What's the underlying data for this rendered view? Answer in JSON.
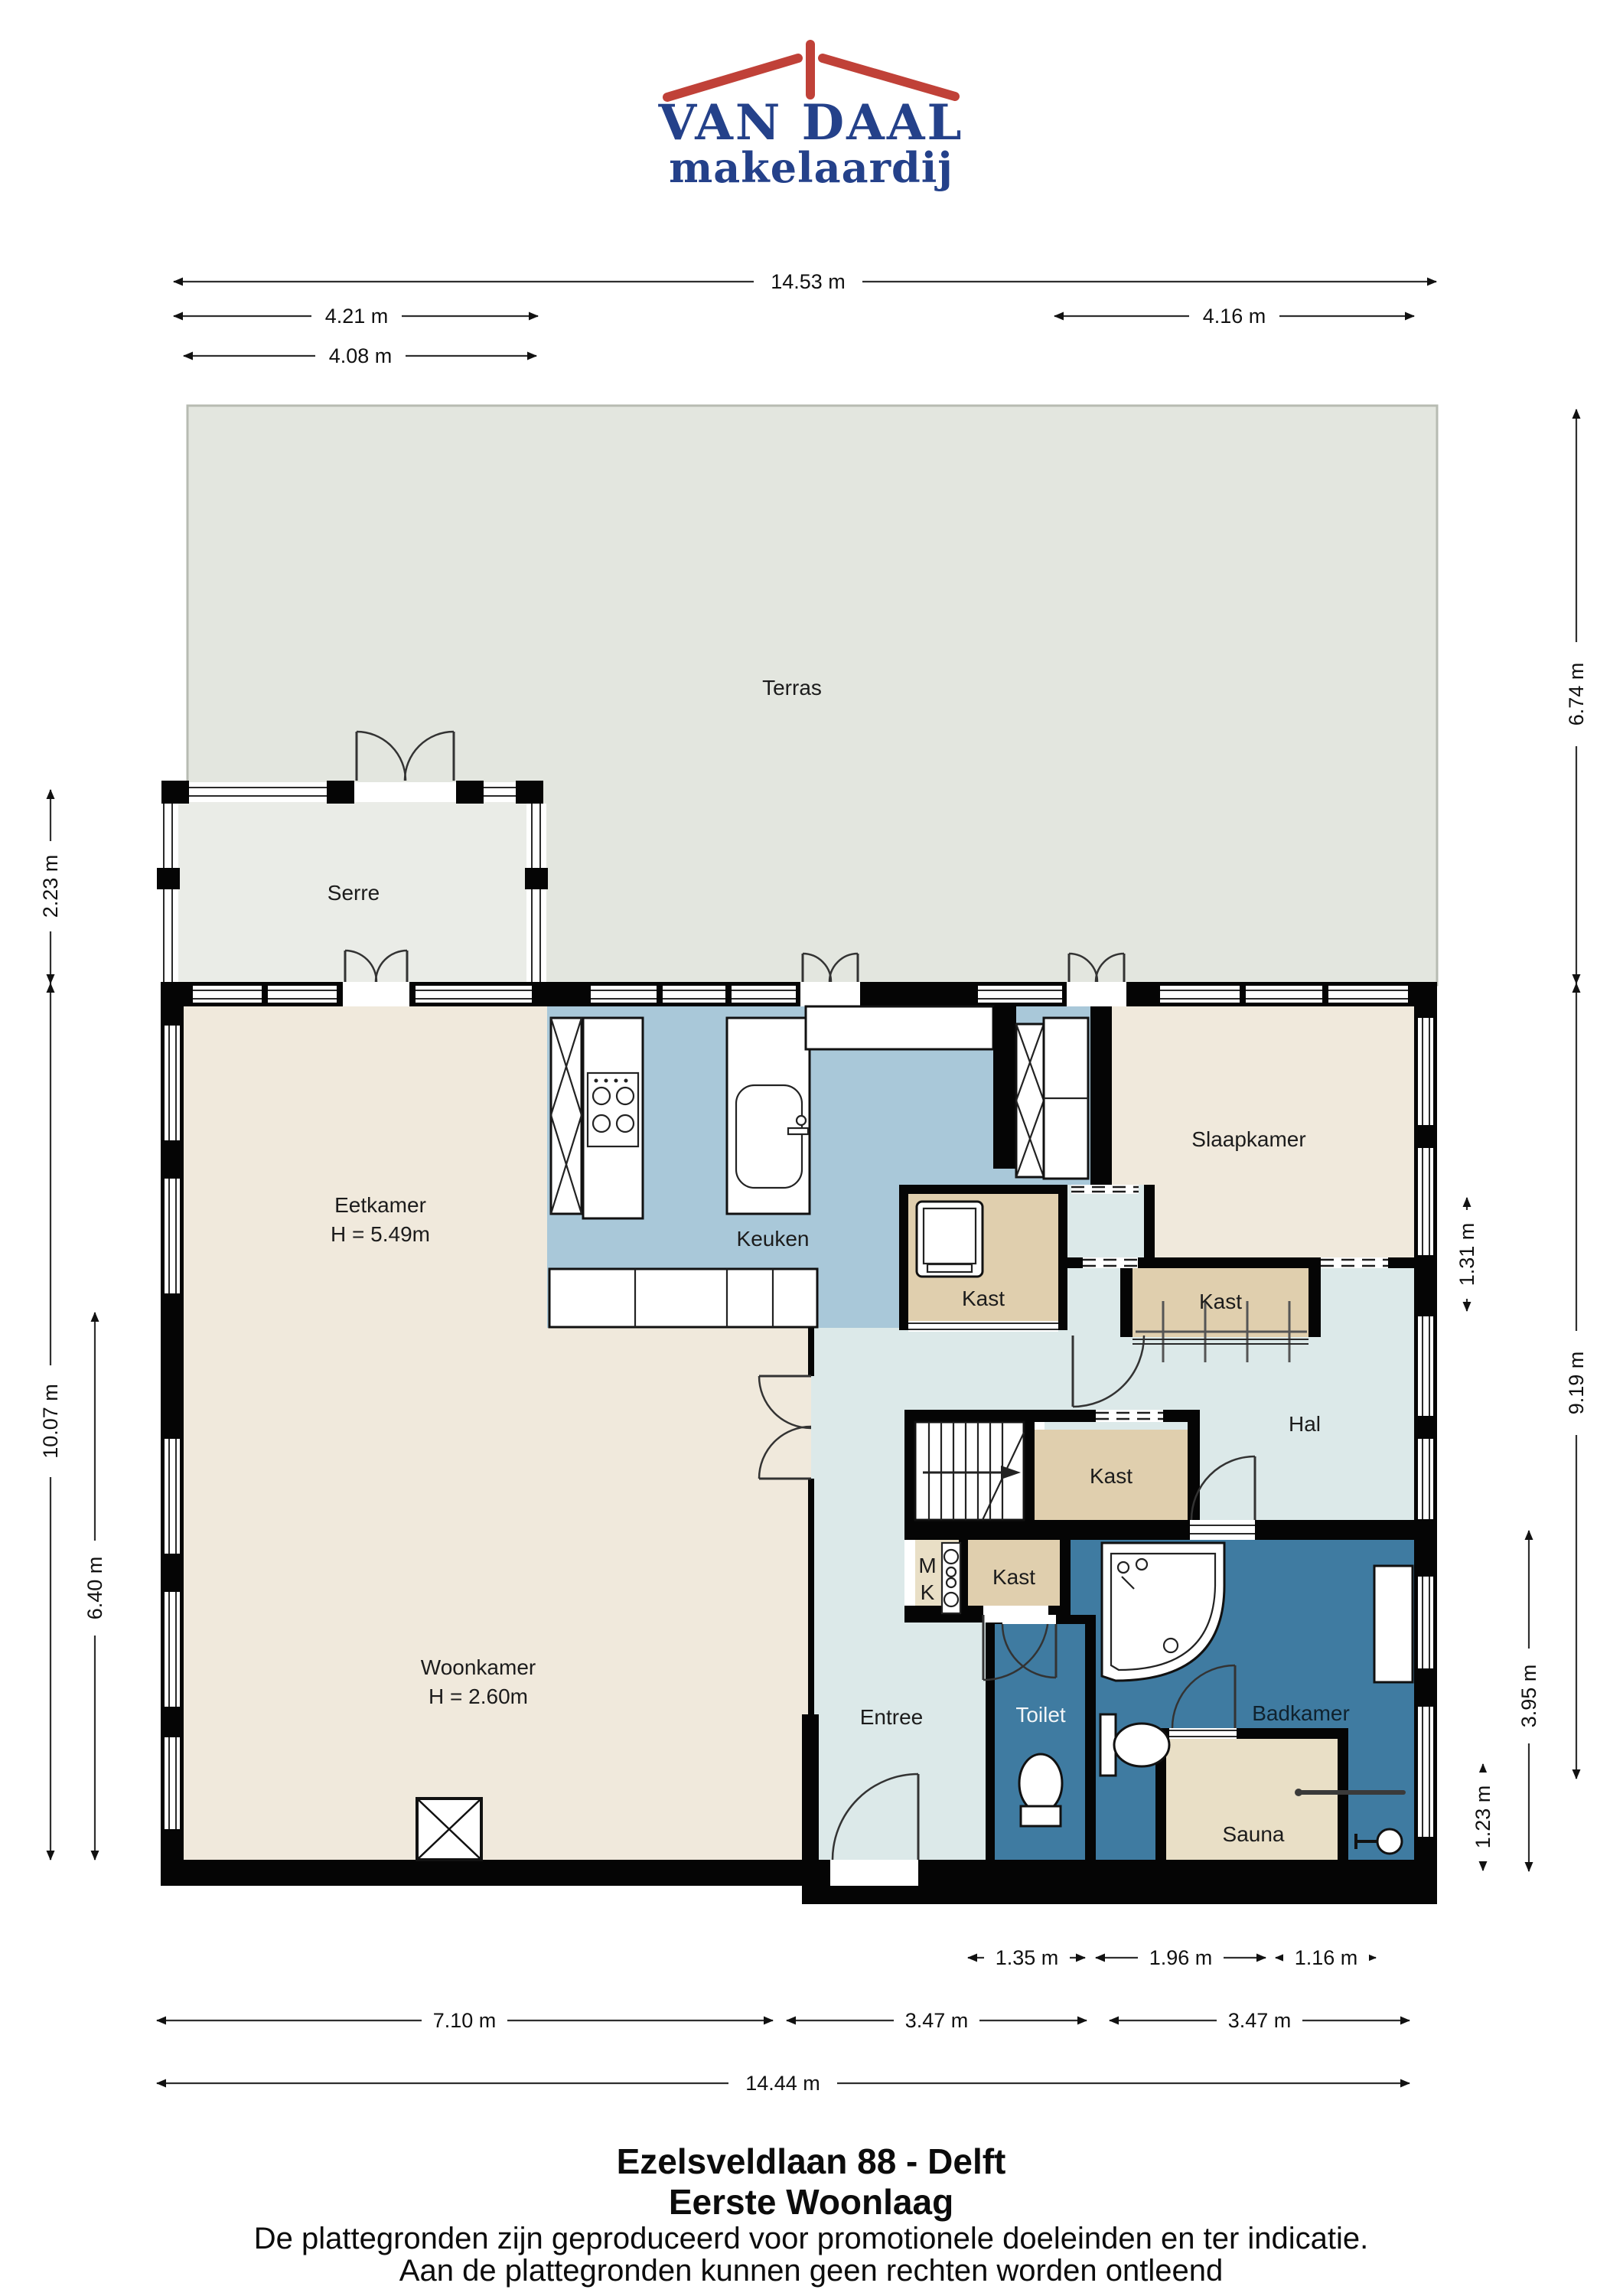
{
  "logo": {
    "brand": "VAN DAAL",
    "tagline": "makelaardij"
  },
  "plan": {
    "rooms": {
      "terras": "Terras",
      "serre": "Serre",
      "eetkamer": "Eetkamer",
      "eetkamer_h": "H = 5.49m",
      "keuken": "Keuken",
      "slaapkamer": "Slaapkamer",
      "kast_slaapkamer": "Kast",
      "kast_wasmachine": "Kast",
      "kast_hal": "Kast",
      "kast_entree": "Kast",
      "hal": "Hal",
      "woonkamer": "Woonkamer",
      "woonkamer_h": "H = 2.60m",
      "entree": "Entree",
      "toilet": "Toilet",
      "badkamer": "Badkamer",
      "sauna": "Sauna",
      "meterkast_line1": "M",
      "meterkast_line2": "K"
    },
    "dims": {
      "top_total": "14.53 m",
      "top_left1": "4.21 m",
      "top_left2": "4.08 m",
      "top_right": "4.16 m",
      "right_terras": "6.74 m",
      "right_kast": "1.31 m",
      "right_house": "9.19 m",
      "right_badkamer": "3.95 m",
      "right_sauna": "1.23 m",
      "left_serre": "2.23 m",
      "left_house": "10.07 m",
      "left_woonkamer": "6.40 m",
      "bottom_toilet": "1.35 m",
      "bottom_sauna": "1.96 m",
      "bottom_right": "1.16 m",
      "bottom_woonkamer": "7.10 m",
      "bottom_mid": "3.47 m",
      "bottom_rechts": "3.47 m",
      "bottom_total": "14.44 m"
    }
  },
  "footer": {
    "address": "Ezelsveldlaan 88 - Delft",
    "floor": "Eerste Woonlaag",
    "disclaimer_line1": "De plattegronden zijn geproduceerd voor promotionele doeleinden en ter indicatie.",
    "disclaimer_line2": "Aan de plattegronden kunnen geen rechten worden ontleend"
  },
  "colors": {
    "brand_blue": "#24418a",
    "brand_red": "#c04138",
    "wall": "#050505",
    "floor_beige": "#f0e9dc",
    "floor_tan": "#e0cfae",
    "floor_sauna": "#e9dfc6",
    "floor_kitchen": "#a9c8d9",
    "floor_hall": "#dce9e9",
    "floor_bath": "#3f7ba1",
    "terras": "#e3e6df",
    "serre": "#eaece7",
    "dim_line": "#2f2f2f"
  }
}
